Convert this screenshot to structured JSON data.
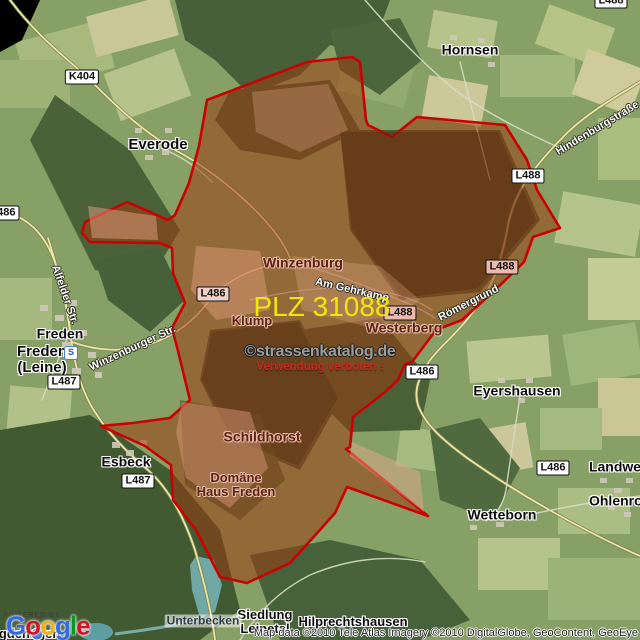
{
  "map": {
    "region": {
      "plz": "PLZ 31088",
      "plz_color": "#efe60a",
      "border_color": "#cc0000",
      "fill_color": "#9e3a10"
    },
    "watermark": {
      "line1": "©strassenkatalog.de",
      "line2": "Verwendung verboten !"
    },
    "attribution": "Map data ©2010 Tele Atlas  Imagery ©2010 DigitalGlobe, GeoContent, GeoEye",
    "logo": {
      "powered_by": "POWERED BY",
      "letters": [
        {
          "ch": "G",
          "color": "#3369E8"
        },
        {
          "ch": "o",
          "color": "#D50F25"
        },
        {
          "ch": "o",
          "color": "#EEB211"
        },
        {
          "ch": "g",
          "color": "#3369E8"
        },
        {
          "ch": "l",
          "color": "#009925"
        },
        {
          "ch": "e",
          "color": "#D50F25"
        }
      ]
    },
    "station_icon": "S",
    "towns": [
      {
        "name": "town-label-hornsen",
        "label": "Hornsen",
        "x": 470,
        "y": 50,
        "size": 14
      },
      {
        "name": "town-label-everode",
        "label": "Everode",
        "x": 158,
        "y": 145,
        "size": 15
      },
      {
        "name": "town-label-freden",
        "label": "Freden",
        "x": 60,
        "y": 334,
        "size": 14
      },
      {
        "name": "town-label-freden-leine",
        "label": "Freden\n(Leine)",
        "x": 42,
        "y": 360,
        "size": 15
      },
      {
        "name": "town-label-esbeck",
        "label": "Esbeck",
        "x": 126,
        "y": 462,
        "size": 14
      },
      {
        "name": "town-label-eyershausen",
        "label": "Eyershausen",
        "x": 517,
        "y": 391,
        "size": 14
      },
      {
        "name": "town-label-wetteborn",
        "label": "Wetteborn",
        "x": 502,
        "y": 515,
        "size": 14
      },
      {
        "name": "town-label-landwehr",
        "label": "Landwehr",
        "x": 622,
        "y": 467,
        "size": 14
      },
      {
        "name": "town-label-ohlenrode",
        "label": "Ohlenrode",
        "x": 624,
        "y": 501,
        "size": 14
      },
      {
        "name": "town-label-siedlung-leinetal",
        "label": "Siedlung\nLeinetal",
        "x": 265,
        "y": 622,
        "size": 13
      },
      {
        "name": "town-label-hilprechtshausen",
        "label": "Hilprechtshausen",
        "x": 353,
        "y": 622,
        "size": 13
      },
      {
        "name": "town-label-egdehagen",
        "label": "egdehagen",
        "x": 26,
        "y": 634,
        "size": 13
      },
      {
        "name": "water-label-unterbecken",
        "label": "Unterbecken",
        "x": 203,
        "y": 621,
        "size": 12,
        "cls": "boxed"
      }
    ],
    "hamlets": [
      {
        "name": "hamlet-label-winzenburg",
        "label": "Winzenburg",
        "x": 303,
        "y": 263,
        "size": 14
      },
      {
        "name": "hamlet-label-klump",
        "label": "Klump",
        "x": 252,
        "y": 321,
        "size": 13
      },
      {
        "name": "hamlet-label-westerberg",
        "label": "Westerberg",
        "x": 404,
        "y": 328,
        "size": 14
      },
      {
        "name": "hamlet-label-schildhorst",
        "label": "Schildhorst",
        "x": 262,
        "y": 437,
        "size": 14
      },
      {
        "name": "hamlet-label-domaene-haus-freden",
        "label": "Domäne\nHaus Freden",
        "x": 236,
        "y": 485,
        "size": 13
      }
    ],
    "streets": [
      {
        "name": "street-label-alfelder-str",
        "label": "Alfelder Str.",
        "x": 64,
        "y": 295,
        "angle": 71
      },
      {
        "name": "street-label-winzenburger-str",
        "label": "Winzenburger Str.",
        "x": 133,
        "y": 349,
        "angle": -25
      },
      {
        "name": "street-label-hindenburgstrasse",
        "label": "Hindenburgstraße",
        "x": 598,
        "y": 129,
        "angle": -31
      },
      {
        "name": "street-label-roemergrund",
        "label": "Römergrund",
        "x": 469,
        "y": 304,
        "angle": -27
      },
      {
        "name": "street-label-am-gehrkamp",
        "label": "Am Gehrkamp",
        "x": 352,
        "y": 291,
        "angle": 13
      }
    ],
    "shields": [
      {
        "name": "road-shield-k404",
        "label": "K404",
        "x": 82,
        "y": 77
      },
      {
        "name": "road-shield-l486-west",
        "label": "L486",
        "x": 3,
        "y": 213
      },
      {
        "name": "road-shield-l487-freden",
        "label": "L487",
        "x": 64,
        "y": 382
      },
      {
        "name": "road-shield-l487-esbeck",
        "label": "L487",
        "x": 138,
        "y": 481
      },
      {
        "name": "road-shield-l486-mid",
        "label": "L486",
        "x": 213,
        "y": 294,
        "bg": "#f0cfc8"
      },
      {
        "name": "road-shield-l486-east",
        "label": "L486",
        "x": 422,
        "y": 372
      },
      {
        "name": "road-shield-l486-southeast",
        "label": "L486",
        "x": 553,
        "y": 468
      },
      {
        "name": "road-shield-l488-north",
        "label": "L488",
        "x": 528,
        "y": 176
      },
      {
        "name": "road-shield-l488-mid",
        "label": "L488",
        "x": 502,
        "y": 267,
        "bg": "#edb9ad"
      },
      {
        "name": "road-shield-l488-westerberg",
        "label": "L488",
        "x": 400,
        "y": 313,
        "bg": "#edb9ad"
      },
      {
        "name": "road-shield-l488-top",
        "label": "L488",
        "x": 611,
        "y": 1
      }
    ]
  }
}
